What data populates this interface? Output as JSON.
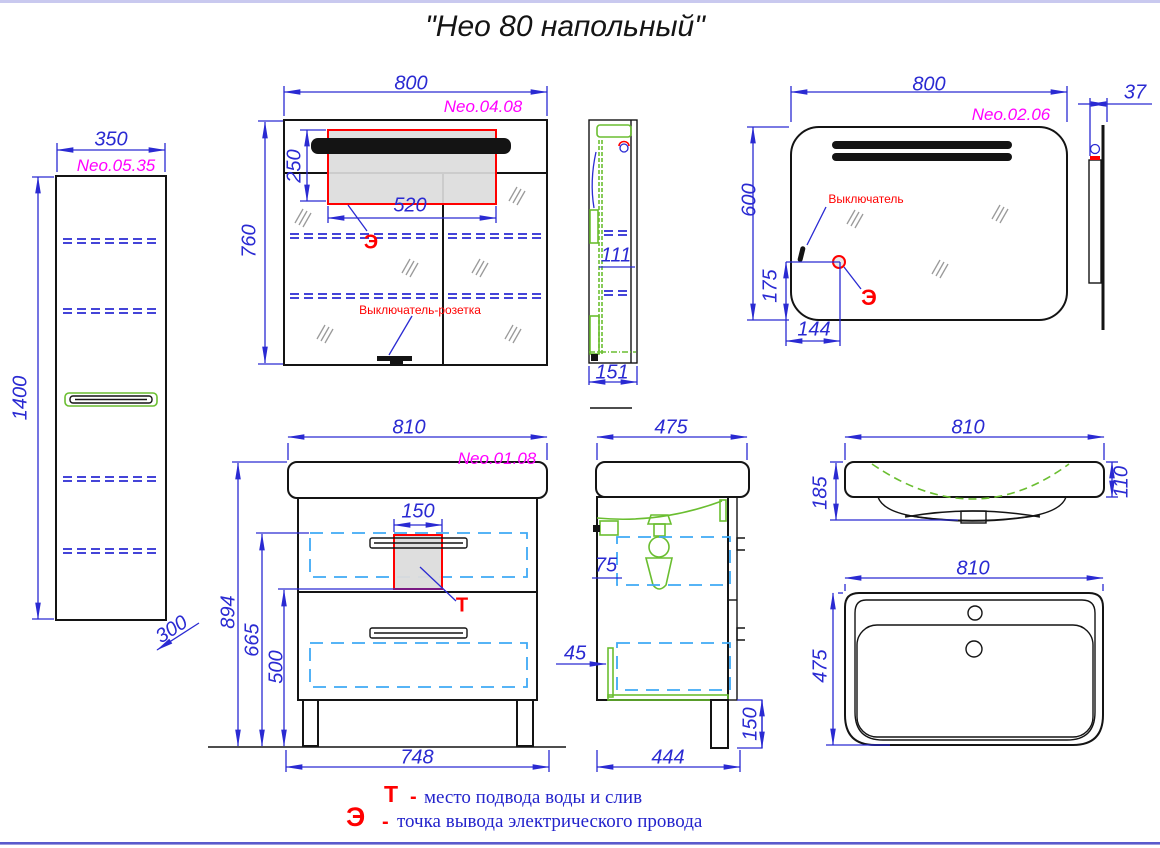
{
  "title": "\"Нео 80 напольный\"",
  "colors": {
    "dimension_blue": "#2a2ad2",
    "model_magenta": "#ff00ff",
    "marker_red": "#ff0000",
    "hardware_green": "#6abe30",
    "drawer_cyan": "#3fa9f5"
  },
  "tall_cabinet": {
    "model": "Neo.05.35",
    "dim_width": "350",
    "dim_height": "1400",
    "dim_depth": "300"
  },
  "mirror_cabinet": {
    "model": "Neo.04.08",
    "dim_width": "800",
    "dim_height": "760",
    "dim_zone_height": "250",
    "dim_zone_width": "520",
    "label_switch": "Выключатель-розетка",
    "marker_e": "Э"
  },
  "mirror_cabinet_side": {
    "dim_inner": "111",
    "dim_depth": "151"
  },
  "mirror": {
    "model": "Neo.02.06",
    "dim_width": "800",
    "dim_height": "600",
    "dim_e_offset_y": "175",
    "dim_e_offset_x": "144",
    "label_switch": "Выключатель",
    "marker_e": "Э"
  },
  "mirror_side": {
    "dim_depth": "37"
  },
  "vanity": {
    "model": "Neo.01.08",
    "dim_width": "810",
    "dim_height": "894",
    "dim_drawer1": "665",
    "dim_drawer2": "500",
    "dim_zone_width": "150",
    "dim_base_width": "748",
    "marker_t": "Т"
  },
  "vanity_side": {
    "dim_depth": "475",
    "dim_gap": "75",
    "dim_offset": "45",
    "dim_base_depth": "444",
    "dim_leg_height": "150"
  },
  "sink_front": {
    "dim_width": "810",
    "dim_height": "185",
    "dim_edge_height": "110"
  },
  "sink_top": {
    "dim_width": "810",
    "dim_depth": "475"
  },
  "legend": {
    "dash": "-",
    "t_symbol": "Т",
    "t_text": "место подвода воды и слив",
    "e_symbol": "Э",
    "e_text": "точка вывода электрического провода"
  }
}
